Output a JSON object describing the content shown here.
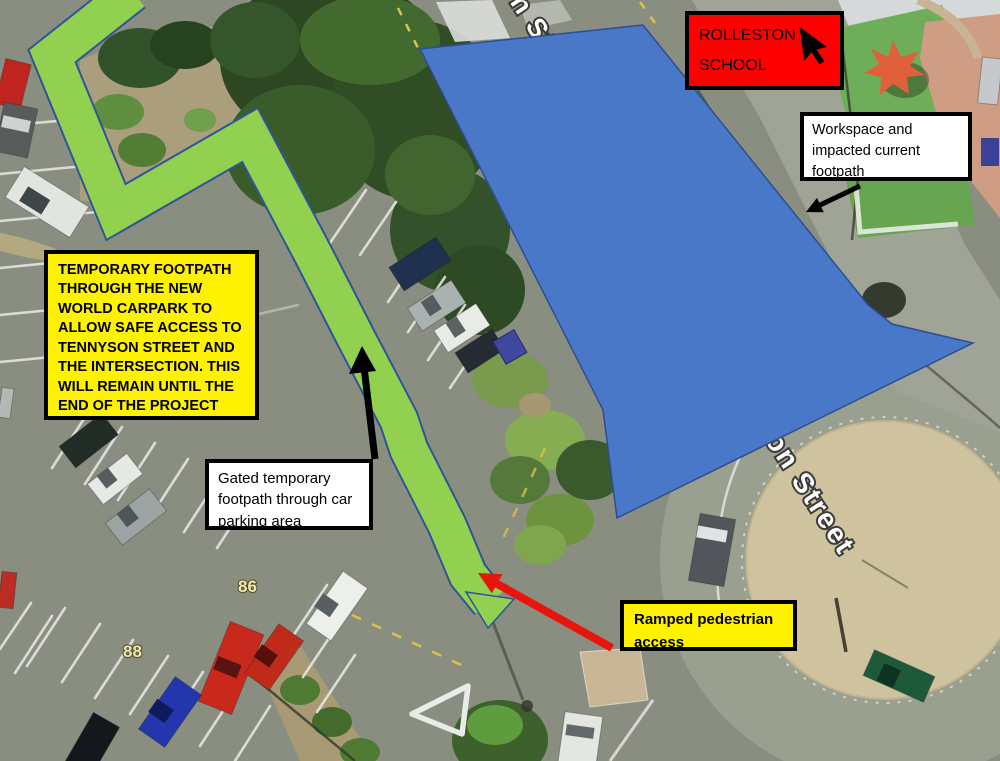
{
  "annotations": {
    "school": {
      "label": "ROLLESTON SCHOOL"
    },
    "workspace": {
      "label": "Workspace and impacted current footpath"
    },
    "temporary_footpath": {
      "label": "TEMPORARY FOOTPATH THROUGH THE NEW WORLD CARPARK TO ALLOW SAFE ACCESS TO TENNYSON STREET AND THE INTERSECTION. THIS WILL REMAIN UNTIL THE END OF THE PROJECT"
    },
    "gated_footpath": {
      "label": "Gated temporary footpath through car parking area"
    },
    "ramped_access": {
      "label": "Ramped pedestrian access"
    }
  },
  "map_labels": {
    "street_top": "n Str",
    "street_right": "on Street",
    "number_86": "86",
    "number_88": "88"
  },
  "colors": {
    "temporary_footpath_green": "#92d050",
    "workspace_blue": "#4472c4",
    "school_box_red": "#ff0000",
    "note_yellow": "#fef200",
    "arrow_red": "#e8150d",
    "arrow_black": "#000000"
  }
}
